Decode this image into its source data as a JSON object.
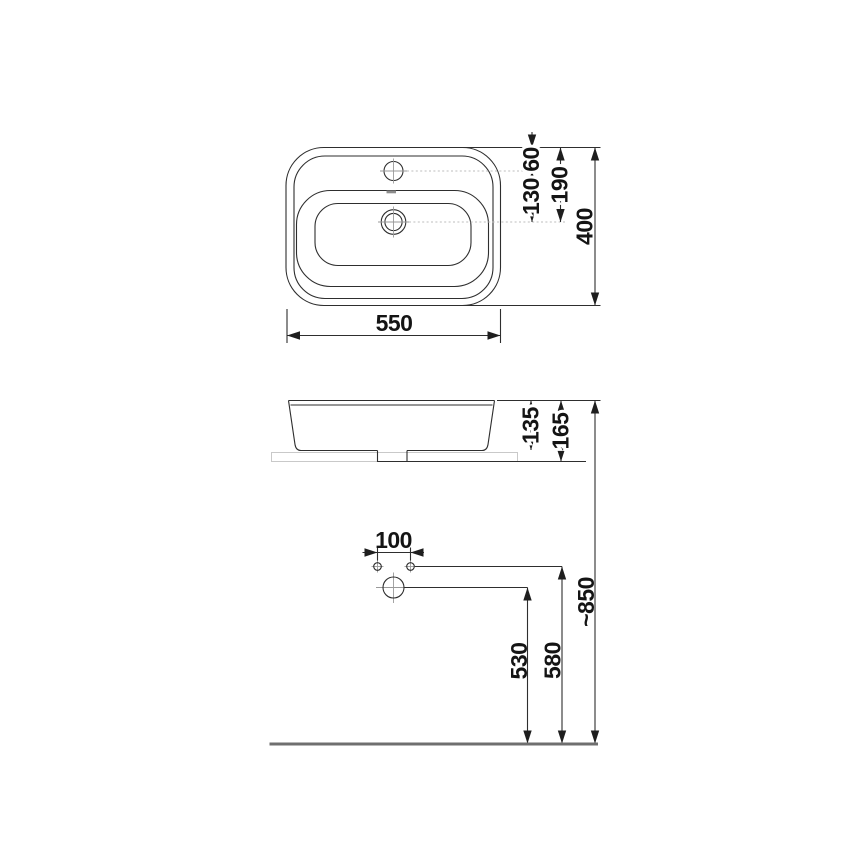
{
  "drawing": {
    "subject": "washbasin technical dimension drawing",
    "units": "mm",
    "colors": {
      "background": "#ffffff",
      "main_line": "#2e2e2e",
      "centerline": "#9a9a9a",
      "counter_line": "#c9c9c9",
      "floor_line": "#6f6f6f",
      "text": "#141414"
    },
    "top_view": {
      "width": "550",
      "faucet_offset": "60",
      "faucet_to_drain": "130",
      "edge_to_drain": "190",
      "depth": "400"
    },
    "side_view": {
      "basin_height": "135",
      "total_height": "165"
    },
    "installation_view": {
      "hole_spacing": "100",
      "drain_height": "530",
      "holes_height": "580",
      "rim_height": "~850"
    }
  }
}
